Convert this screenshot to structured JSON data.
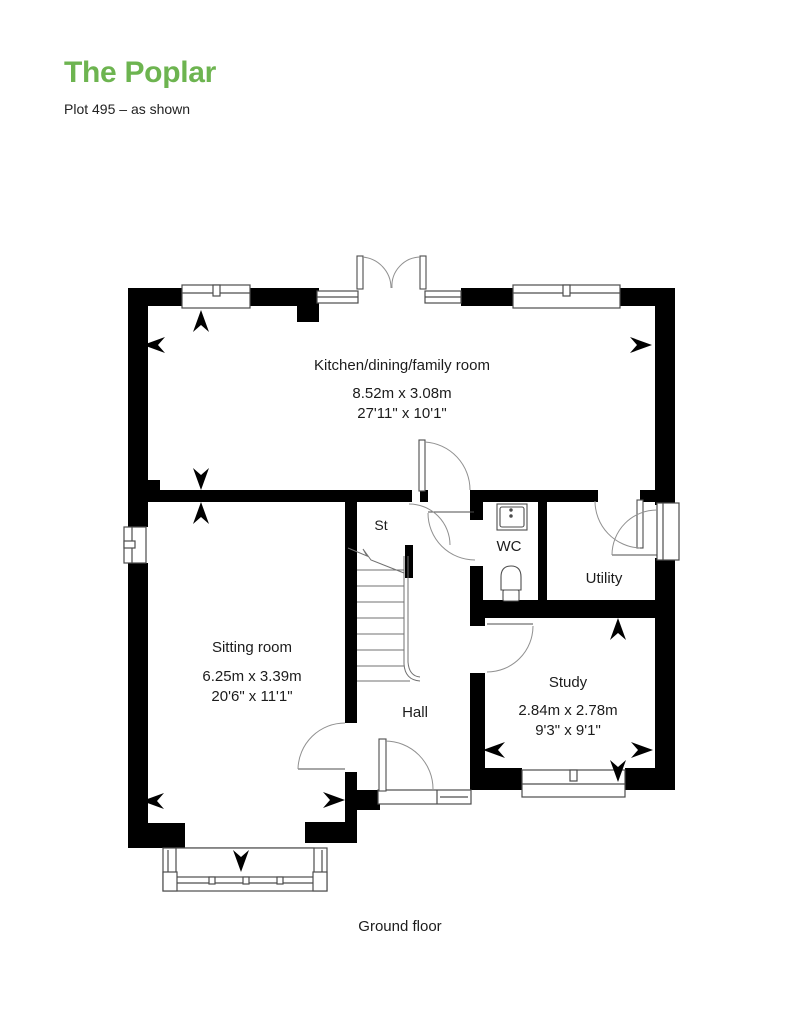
{
  "header": {
    "title": "The Poplar",
    "subtitle": "Plot 495 – as shown"
  },
  "plan": {
    "rooms": {
      "kitchen": {
        "name": "Kitchen/dining/family room",
        "metric": "8.52m x 3.08m",
        "imperial": "27'11\" x 10'1\""
      },
      "sitting": {
        "name": "Sitting room",
        "metric": "6.25m x 3.39m",
        "imperial": "20'6\" x 11'1\""
      },
      "study": {
        "name": "Study",
        "metric": "2.84m x 2.78m",
        "imperial": "9'3\" x 9'1\""
      },
      "hall": {
        "name": "Hall"
      },
      "wc": {
        "name": "WC"
      },
      "utility": {
        "name": "Utility"
      },
      "store": {
        "name": "St"
      }
    },
    "caption": "Ground floor"
  },
  "colors": {
    "accent_green": "#6db450",
    "wall_black": "#000000",
    "line_gray": "#555555",
    "text_dark": "#1c1c1c"
  }
}
